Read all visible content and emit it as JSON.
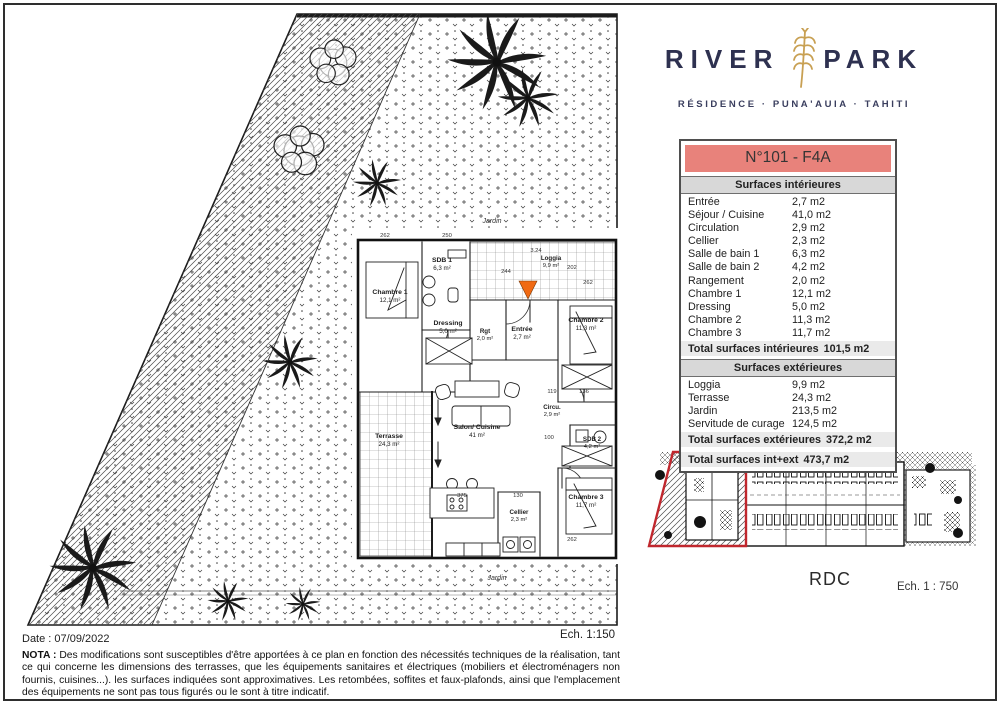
{
  "logo": {
    "title_left": "RIVER",
    "title_right": "PARK",
    "subtitle": "RÉSIDENCE · PUNA'AUIA · TAHITI",
    "accent_color": "#c8a053",
    "text_color": "#2e3150"
  },
  "unit_table": {
    "title": "N°101 - F4A",
    "title_bg_color": "#e8827b",
    "interior": {
      "header": "Surfaces intérieures",
      "rows": [
        {
          "label": "Entrée",
          "value": "2,7 m2"
        },
        {
          "label": "Séjour / Cuisine",
          "value": "41,0 m2"
        },
        {
          "label": "Circulation",
          "value": "2,9 m2"
        },
        {
          "label": "Cellier",
          "value": "2,3 m2"
        },
        {
          "label": "Salle de bain 1",
          "value": "6,3 m2"
        },
        {
          "label": "Salle de bain 2",
          "value": "4,2 m2"
        },
        {
          "label": "Rangement",
          "value": "2,0 m2"
        },
        {
          "label": "Chambre 1",
          "value": "12,1 m2"
        },
        {
          "label": "Dressing",
          "value": "5,0 m2"
        },
        {
          "label": "Chambre 2",
          "value": "11,3 m2"
        },
        {
          "label": "Chambre 3",
          "value": "11,7 m2"
        }
      ],
      "total": {
        "label": "Total surfaces intérieures",
        "value": "101,5 m2"
      }
    },
    "exterior": {
      "header": "Surfaces extérieures",
      "rows": [
        {
          "label": "Loggia",
          "value": "9,9 m2"
        },
        {
          "label": "Terrasse",
          "value": "24,3 m2"
        },
        {
          "label": "Jardin",
          "value": "213,5 m2"
        },
        {
          "label": "Servitude de curage",
          "value": "124,5 m2"
        }
      ],
      "total": {
        "label": "Total surfaces extérieures",
        "value": "372,2 m2"
      }
    },
    "grand_total": {
      "label": "Total surfaces int+ext",
      "value": "473,7 m2"
    }
  },
  "floor_plan": {
    "scale_label": "Ech. 1:150",
    "marker_color": "#f06a13",
    "garden_label_top": "Jardin",
    "garden_label_bottom": "Jardin",
    "rooms": [
      {
        "name": "Chambre 1",
        "area": "12,1 m²"
      },
      {
        "name": "SDB 1",
        "area": "6,3 m²"
      },
      {
        "name": "Loggia",
        "area": "9,9 m²"
      },
      {
        "name": "Chambre 2",
        "area": "11,3 m²"
      },
      {
        "name": "Dressing",
        "area": "5,0 m²"
      },
      {
        "name": "Rgt",
        "area": "2,0 m²"
      },
      {
        "name": "Entrée",
        "area": "2,7 m²"
      },
      {
        "name": "Terrasse",
        "area": "24,3 m²"
      },
      {
        "name": "Salon/ Cuisine",
        "area": "41 m²"
      },
      {
        "name": "Circu.",
        "area": "2,9 m²"
      },
      {
        "name": "SDB 2",
        "area": "4,2 m²"
      },
      {
        "name": "Chambre 3",
        "area": "11,7 m²"
      },
      {
        "name": "Cellier",
        "area": "2,3 m²"
      }
    ],
    "dims": [
      {
        "t": "262"
      },
      {
        "t": "250"
      },
      {
        "t": "3.24"
      },
      {
        "t": "244"
      },
      {
        "t": "202"
      },
      {
        "t": "262"
      },
      {
        "t": "119"
      },
      {
        "t": "136"
      },
      {
        "t": "100"
      },
      {
        "t": "375"
      },
      {
        "t": "130"
      },
      {
        "t": "262"
      }
    ]
  },
  "site_plan": {
    "floor_label": "RDC",
    "scale_label": "Ech. 1 : 750",
    "highlight_color": "#c0272d"
  },
  "footer": {
    "date_label": "Date : 07/09/2022",
    "nota_bold": "NOTA :",
    "nota_text": "Des modifications sont susceptibles d'être apportées à ce plan en fonction des nécessités techniques de la réalisation, tant ce qui concerne les dimensions des terrasses, que les équipements sanitaires et électriques (mobiliers et électroménagers non fournis, cuisines...). les surfaces indiquées sont approximatives. Les retombées, soffites et faux-plafonds, ainsi que l'emplacement des équipements ne sont pas tous figurés ou le sont à titre indicatif."
  }
}
